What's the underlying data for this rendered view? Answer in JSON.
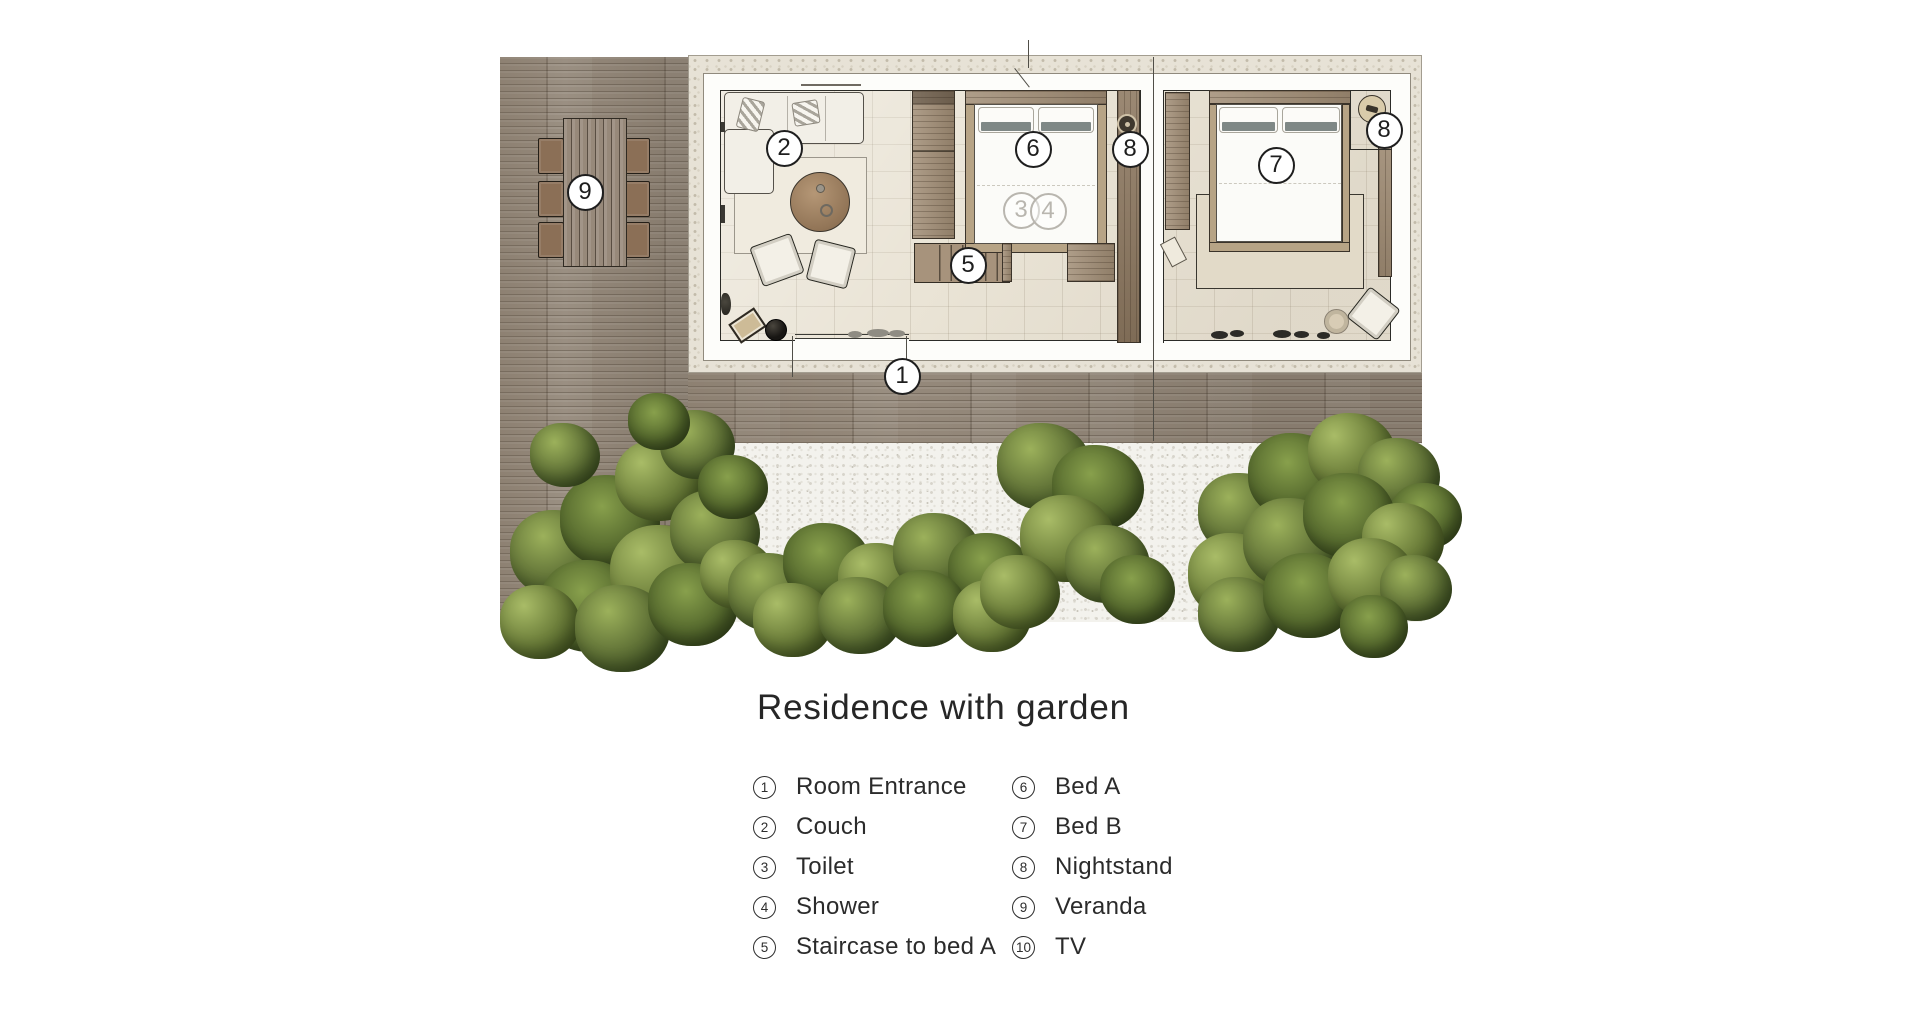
{
  "title": "Residence with garden",
  "legend": {
    "columns": [
      {
        "items": [
          {
            "num": "1",
            "label": "Room Entrance"
          },
          {
            "num": "2",
            "label": "Couch"
          },
          {
            "num": "3",
            "label": "Toilet"
          },
          {
            "num": "4",
            "label": "Shower"
          },
          {
            "num": "5",
            "label": "Staircase to bed A"
          }
        ]
      },
      {
        "items": [
          {
            "num": "6",
            "label": "Bed A"
          },
          {
            "num": "7",
            "label": "Bed B"
          },
          {
            "num": "8",
            "label": "Nightstand"
          },
          {
            "num": "9",
            "label": "Veranda"
          },
          {
            "num": "10",
            "label": "TV"
          }
        ]
      }
    ]
  },
  "plan": {
    "markers": [
      {
        "num": "9",
        "x": 85,
        "y": 137,
        "faded": false
      },
      {
        "num": "2",
        "x": 284,
        "y": 93,
        "faded": false
      },
      {
        "num": "6",
        "x": 533,
        "y": 94,
        "faded": false
      },
      {
        "num": "8",
        "x": 630,
        "y": 94,
        "faded": false
      },
      {
        "num": "7",
        "x": 776,
        "y": 110,
        "faded": false
      },
      {
        "num": "8",
        "x": 884,
        "y": 75,
        "faded": false
      },
      {
        "num": "3",
        "x": 521,
        "y": 155,
        "faded": true
      },
      {
        "num": "4",
        "x": 548,
        "y": 156,
        "faded": true
      },
      {
        "num": "5",
        "x": 468,
        "y": 210,
        "faded": false
      },
      {
        "num": "1",
        "x": 402,
        "y": 321,
        "faded": false
      }
    ]
  },
  "colors": {
    "marker_ink": "#1e1e1e",
    "marker_faded_ink": "#b9b6af",
    "page_background": "#ffffff"
  }
}
